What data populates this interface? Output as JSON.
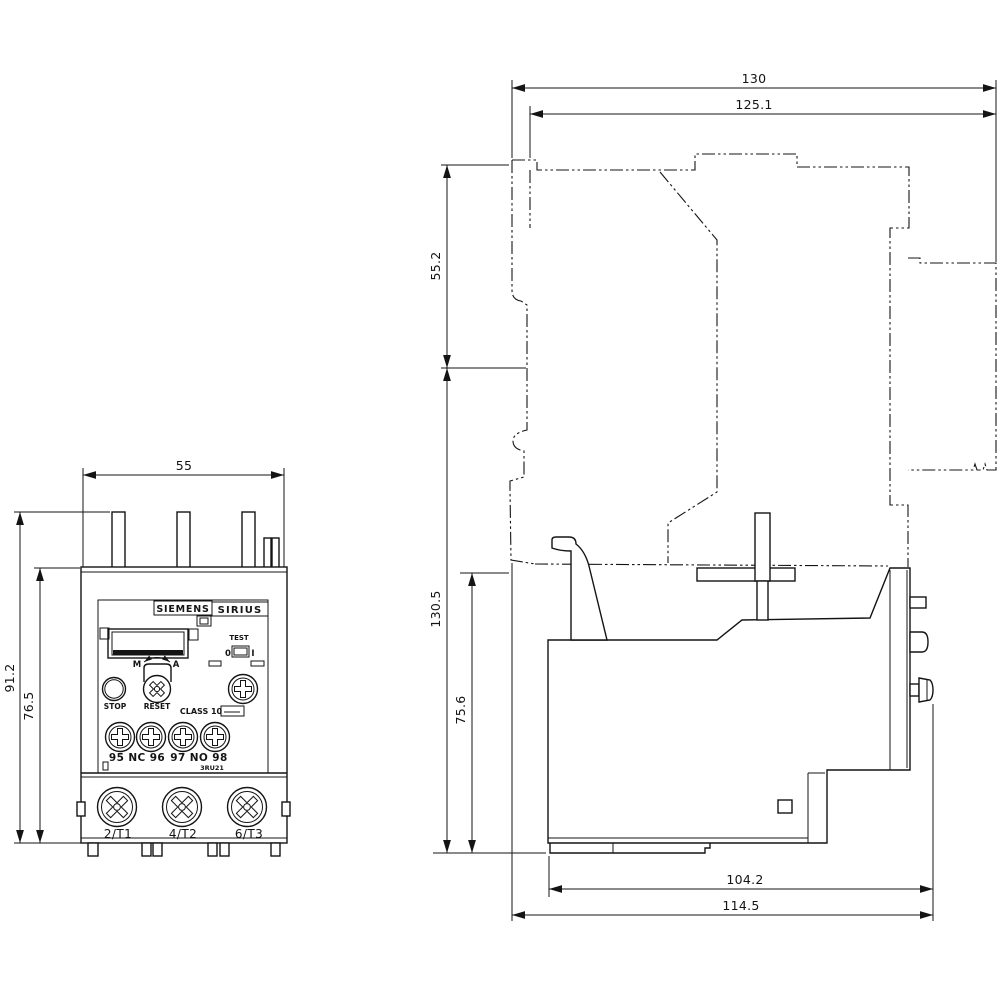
{
  "front_view": {
    "dim_width": "55",
    "dim_height_total": "91.2",
    "dim_height_body": "76.5",
    "brand_siemens": "SIEMENS",
    "brand_sirius": "SIRIUS",
    "test_label": "TEST",
    "test_off": "0",
    "test_on": "I",
    "dial_manual": "M",
    "dial_auto": "A",
    "stop_label": "STOP",
    "reset_label": "RESET",
    "class_label": "CLASS 10",
    "aux_nc": "95 NC 96",
    "aux_no": "97 NO 98",
    "model": "3RU21",
    "terminals": [
      "2/T1",
      "4/T2",
      "6/T3"
    ]
  },
  "side_view": {
    "dim_depth_total": "130",
    "dim_depth_body": "125.1",
    "dim_height_upper": "55.2",
    "dim_height_total": "130.5",
    "dim_height_lower": "75.6",
    "dim_depth_lower": "104.2",
    "dim_depth_lower_total": "114.5"
  }
}
